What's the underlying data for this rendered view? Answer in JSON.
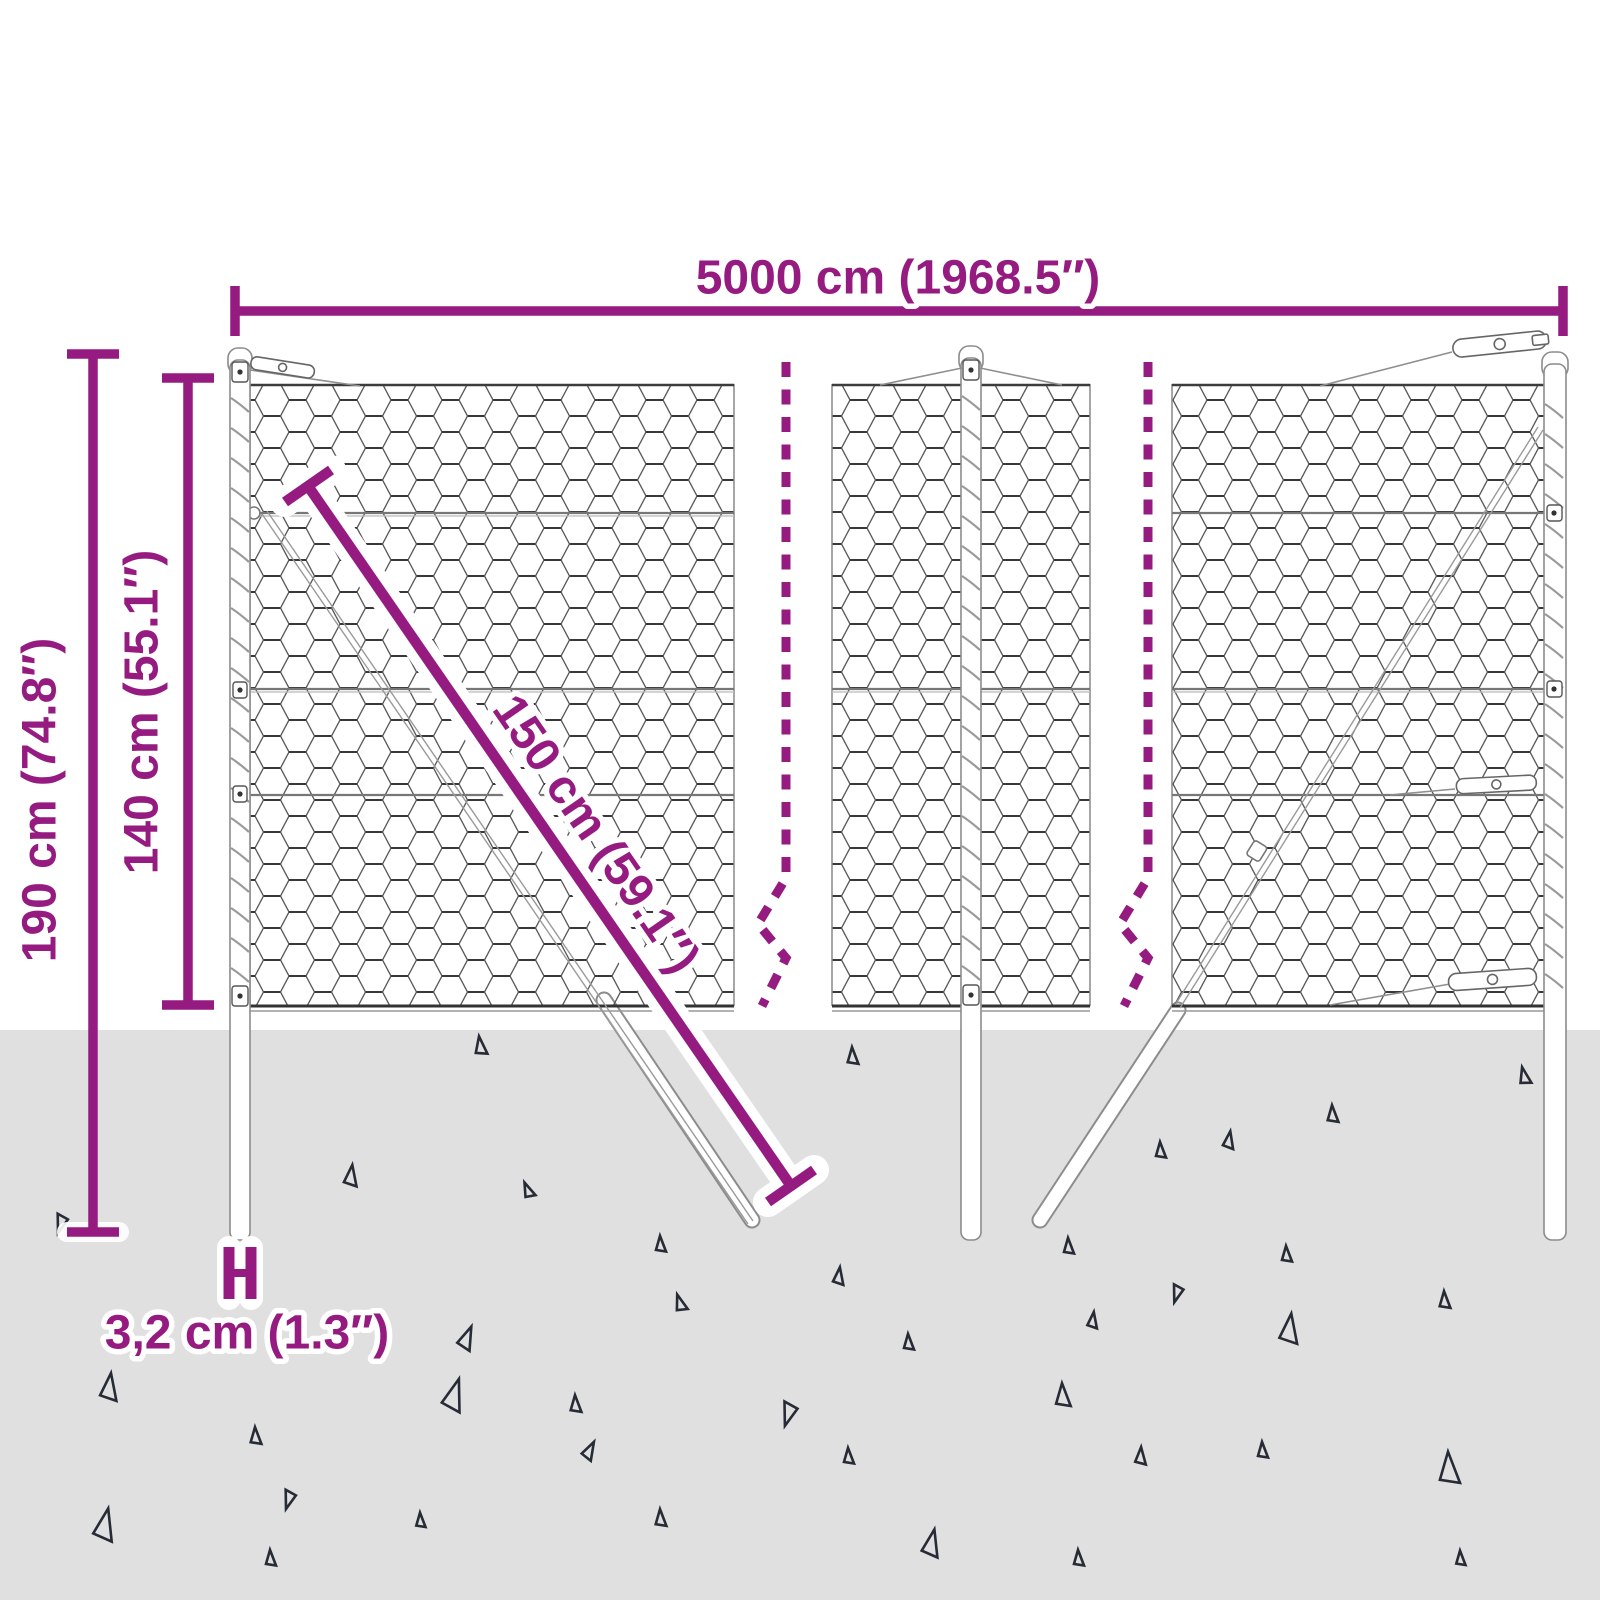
{
  "labels": {
    "total_width": "5000 cm (1968.5″)",
    "total_height": "190 cm (74.8″)",
    "mesh_height": "140 cm (55.1″)",
    "strut_length": "150 cm (59.1″)",
    "post_diameter": "3,2 cm (1.3″)"
  },
  "colors": {
    "dimension_purple": "#951b81",
    "ground_gray": "#e0e0e0",
    "mesh_wire": "#555555",
    "mesh_wire_dark": "#383838",
    "triangle_outline": "#262b36",
    "post_outline": "#8c8c8c"
  }
}
